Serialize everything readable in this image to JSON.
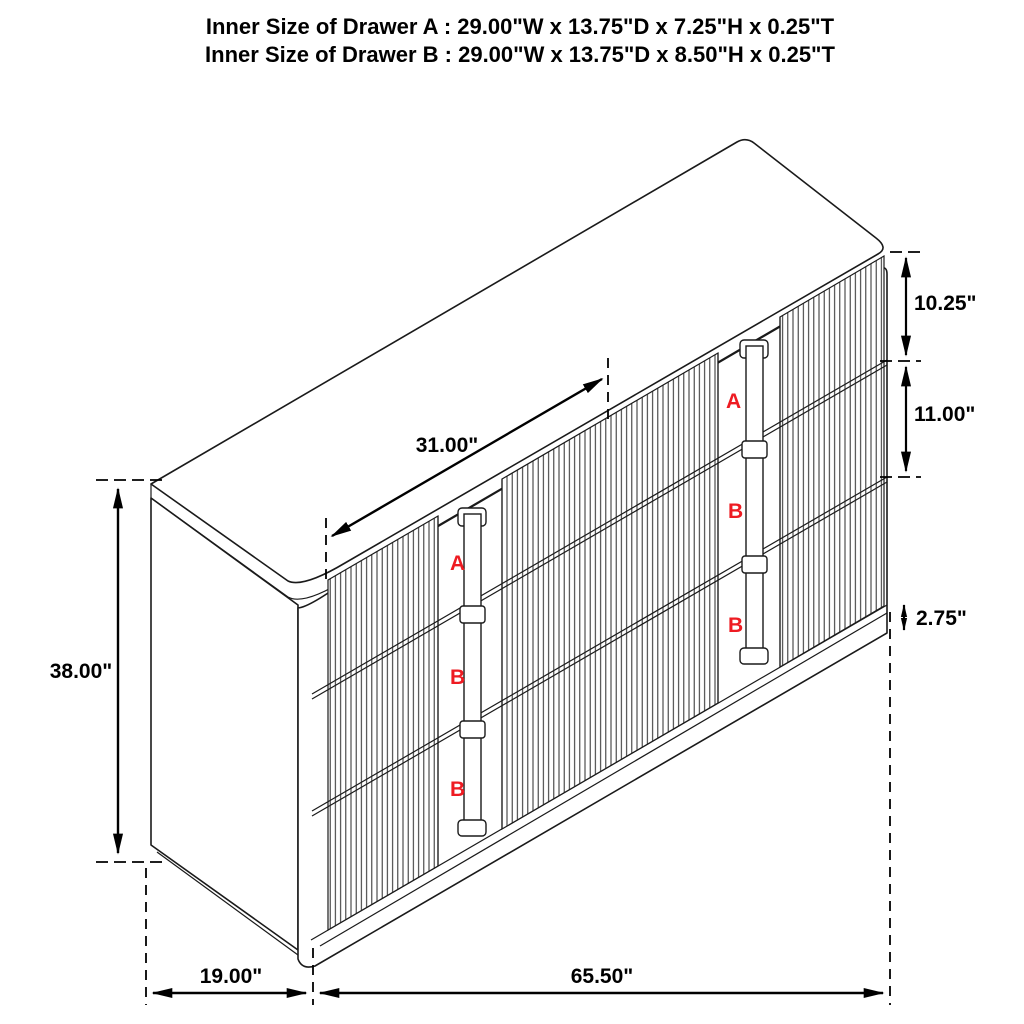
{
  "title": {
    "line1": "Inner Size of Drawer A : 29.00\"W x 13.75\"D x 7.25\"H x 0.25\"T",
    "line2": "Inner Size of Drawer B : 29.00\"W x 13.75\"D x 8.50\"H x 0.25\"T"
  },
  "dimensions": {
    "drawer_width": "31.00\"",
    "total_height": "38.00\"",
    "top_drawer_height": "10.25\"",
    "lower_drawer_height": "11.00\"",
    "base_height": "2.75\"",
    "depth": "19.00\"",
    "total_width": "65.50\""
  },
  "drawer_labels": {
    "left": [
      "A",
      "B",
      "B"
    ],
    "right": [
      "A",
      "B",
      "B"
    ]
  },
  "colors": {
    "line": "#1a1a1a",
    "dimension": "#000000",
    "drawer_letter_red": "#ee1b22",
    "background": "#ffffff"
  }
}
